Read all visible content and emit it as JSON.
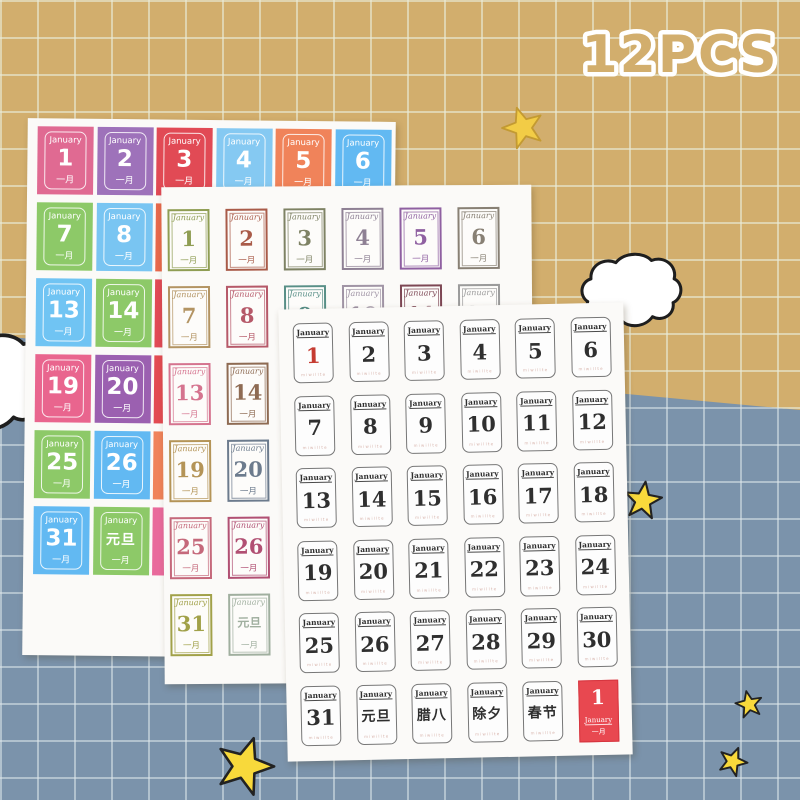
{
  "badge": {
    "text": "12PCS"
  },
  "palette": {
    "bg_top": "#d2ae6d",
    "bg_bottom": "#7b93ab",
    "badge_fill": "#d2ae6d",
    "badge_stroke": "#ffffff",
    "front_day1_red": "#c53b31",
    "red_stamp_bg": "#e84850",
    "star_fill": "#f8d93b",
    "star_outline": "#222222",
    "cloud_fill": "#ffffff",
    "cloud_outline": "#1e1e1e"
  },
  "icons": {
    "star": "star-icon",
    "cloud": "cloud-icon"
  },
  "sheets": {
    "back": {
      "style": "colorful-tiles",
      "month": "January",
      "sub": "一月",
      "tiles": [
        {
          "d": "1",
          "c": "#e06a92",
          "row": 0,
          "col": 0
        },
        {
          "d": "2",
          "c": "#9e72ba",
          "row": 0,
          "col": 1
        },
        {
          "d": "3",
          "c": "#e14a55",
          "row": 0,
          "col": 2
        },
        {
          "d": "4",
          "c": "#85c9f2",
          "row": 0,
          "col": 3
        },
        {
          "d": "5",
          "c": "#f0835a",
          "row": 0,
          "col": 4
        },
        {
          "d": "6",
          "c": "#62b9f2",
          "row": 0,
          "col": 5
        },
        {
          "d": "7",
          "c": "#8dc968",
          "row": 1,
          "col": 0
        },
        {
          "d": "8",
          "c": "#79c5f2",
          "row": 1,
          "col": 1
        },
        {
          "c": "#e8694c",
          "row": 1,
          "col": 2,
          "edge": true
        },
        {
          "d": "13",
          "c": "#70c4f3",
          "row": 2,
          "col": 0
        },
        {
          "d": "14",
          "c": "#8dc968",
          "row": 2,
          "col": 1
        },
        {
          "c": "#e14a55",
          "row": 2,
          "col": 2,
          "edge": true
        },
        {
          "d": "19",
          "c": "#e9658e",
          "row": 3,
          "col": 0
        },
        {
          "d": "20",
          "c": "#9b60b0",
          "row": 3,
          "col": 1
        },
        {
          "c": "#e34b52",
          "row": 3,
          "col": 2,
          "edge": true
        },
        {
          "d": "25",
          "c": "#8dc968",
          "row": 4,
          "col": 0
        },
        {
          "d": "26",
          "c": "#62b9f2",
          "row": 4,
          "col": 1
        },
        {
          "c": "#f0835a",
          "row": 4,
          "col": 2,
          "edge": true
        },
        {
          "d": "31",
          "c": "#62b9f2",
          "row": 5,
          "col": 0
        },
        {
          "d": "元旦",
          "c": "#8dc968",
          "row": 5,
          "col": 1
        },
        {
          "c": "#e96a9c",
          "row": 5,
          "col": 2,
          "edge": true
        }
      ]
    },
    "middle": {
      "style": "colored-border-stamps",
      "month": "January",
      "sub": "一月",
      "stamps": [
        {
          "d": "1",
          "c": "#8f9d53",
          "row": 0,
          "col": 0
        },
        {
          "d": "2",
          "c": "#a95b49",
          "row": 0,
          "col": 1
        },
        {
          "d": "3",
          "c": "#7e8264",
          "row": 0,
          "col": 2
        },
        {
          "d": "4",
          "c": "#8e8094",
          "row": 0,
          "col": 3
        },
        {
          "d": "5",
          "c": "#8f60a1",
          "row": 0,
          "col": 4
        },
        {
          "d": "6",
          "c": "#888074",
          "row": 0,
          "col": 5
        },
        {
          "d": "7",
          "c": "#b39463",
          "row": 1,
          "col": 0
        },
        {
          "d": "8",
          "c": "#b65969",
          "row": 1,
          "col": 1
        },
        {
          "d": "9",
          "c": "#588f87",
          "row": 1,
          "col": 2
        },
        {
          "d": "10",
          "c": "#a094a5",
          "row": 1,
          "col": 3
        },
        {
          "d": "11",
          "c": "#7d4754",
          "row": 1,
          "col": 4
        },
        {
          "d": "12",
          "c": "#9b9b9b",
          "row": 1,
          "col": 5
        },
        {
          "d": "13",
          "c": "#d5748f",
          "row": 2,
          "col": 0
        },
        {
          "d": "14",
          "c": "#8e6b53",
          "row": 2,
          "col": 1
        },
        {
          "d": "19",
          "c": "#b49457",
          "row": 3,
          "col": 0
        },
        {
          "d": "20",
          "c": "#6c7b8d",
          "row": 3,
          "col": 1
        },
        {
          "d": "25",
          "c": "#c5697b",
          "row": 4,
          "col": 0
        },
        {
          "d": "26",
          "c": "#b15073",
          "row": 4,
          "col": 1
        },
        {
          "d": "31",
          "c": "#a1a149",
          "row": 5,
          "col": 0
        },
        {
          "d": "元旦",
          "c": "#a0af9f",
          "row": 5,
          "col": 1
        }
      ]
    },
    "front": {
      "style": "black-white-stamps",
      "month": "January",
      "micro_text": "miwillte",
      "first_day_red": true,
      "cells": [
        "1",
        "2",
        "3",
        "4",
        "5",
        "6",
        "7",
        "8",
        "9",
        "10",
        "11",
        "12",
        "13",
        "14",
        "15",
        "16",
        "17",
        "18",
        "19",
        "20",
        "21",
        "22",
        "23",
        "24",
        "25",
        "26",
        "27",
        "28",
        "29",
        "30",
        "31",
        "元旦",
        "腊八",
        "除夕",
        "春节"
      ],
      "red_stamp": {
        "day": "1",
        "month": "January",
        "sub": "一月"
      }
    }
  }
}
